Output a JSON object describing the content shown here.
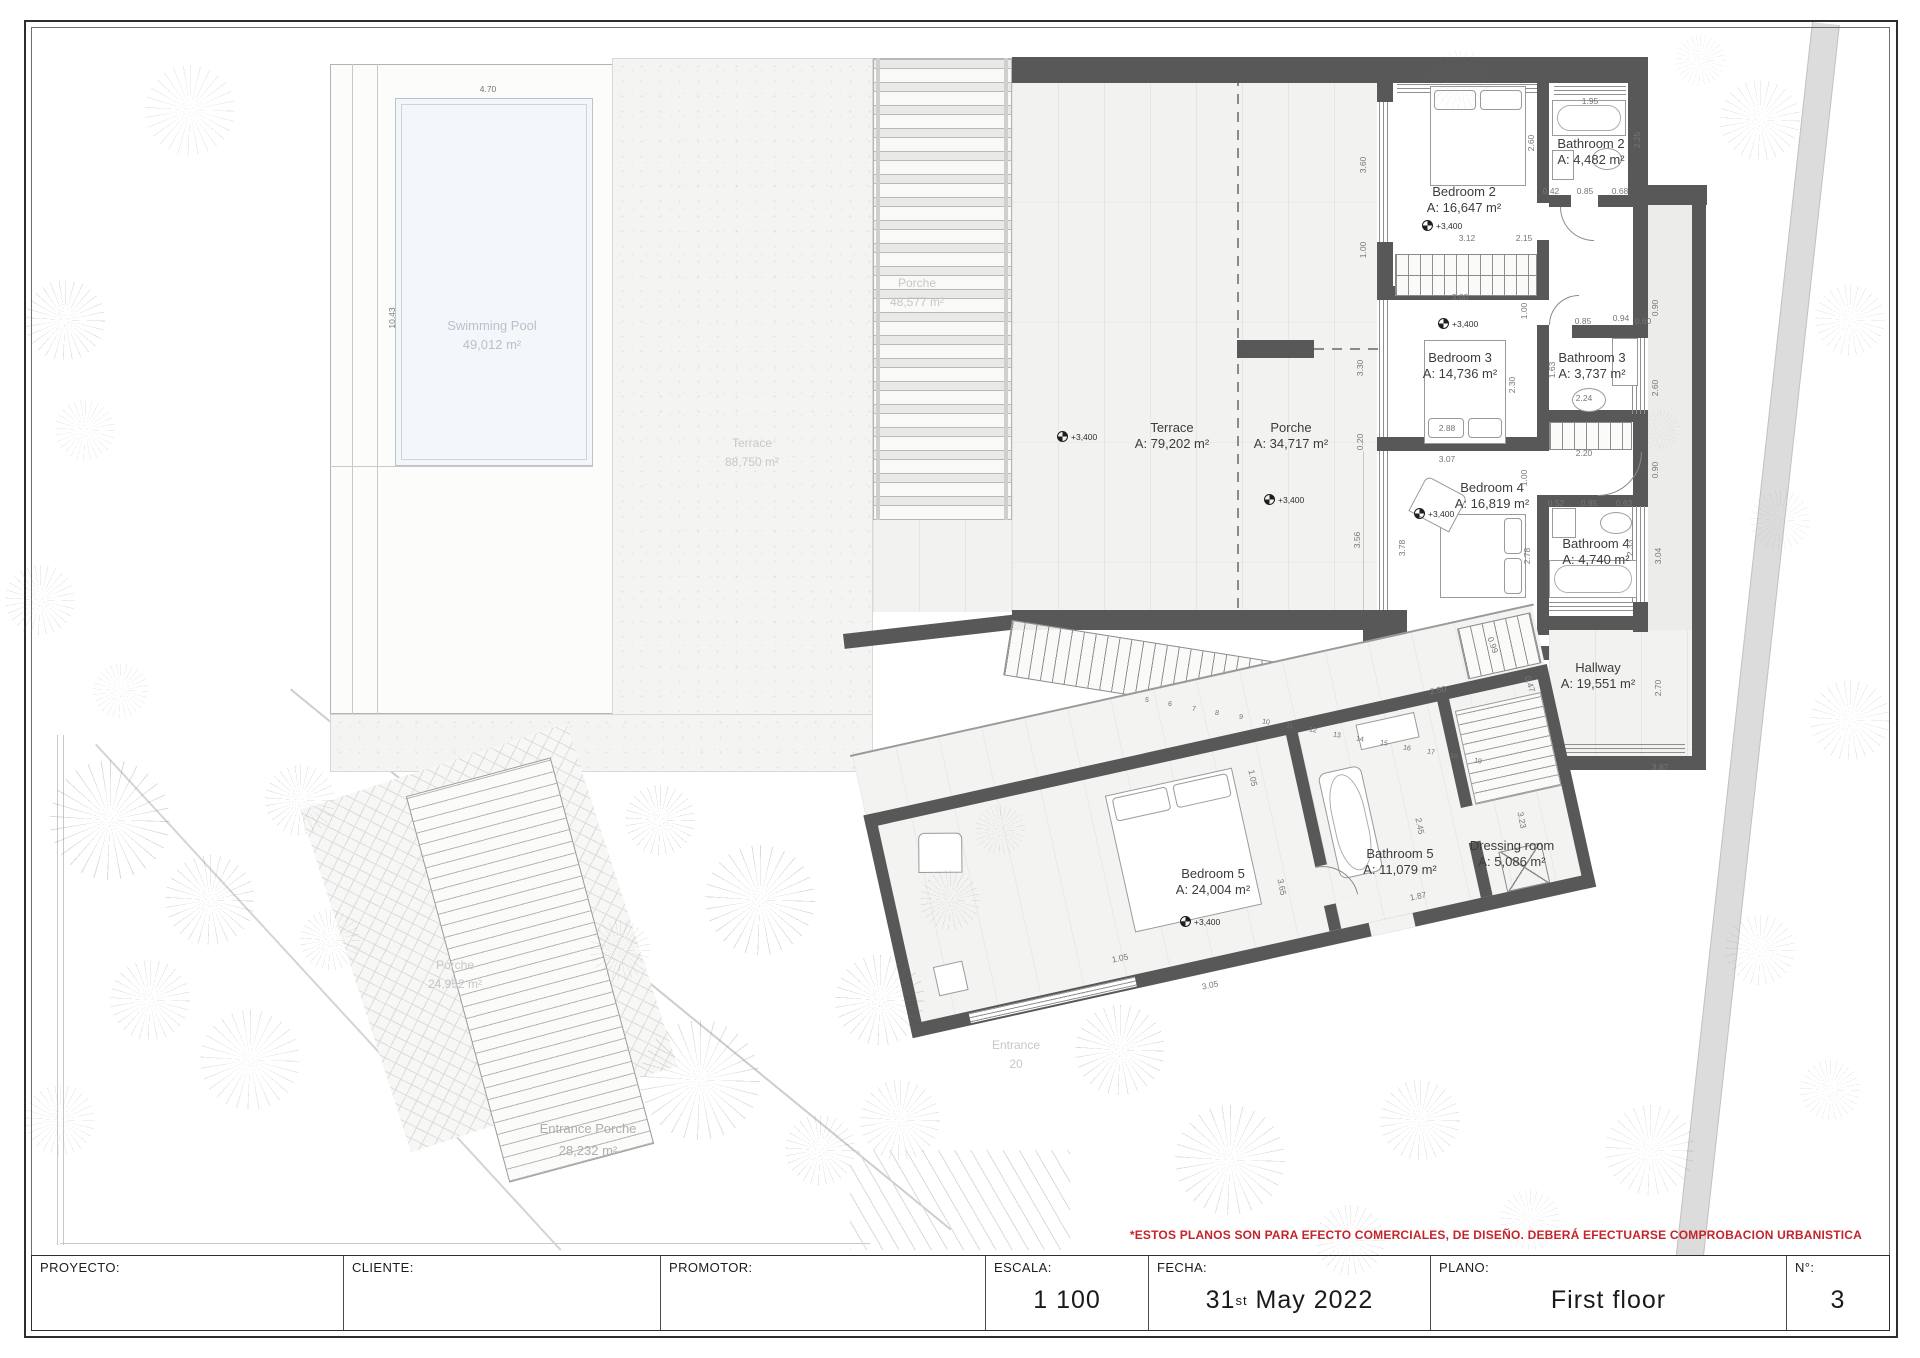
{
  "sheet": {
    "disclaimer": "*ESTOS PLANOS SON PARA EFECTO COMERCIALES, DE DISEÑO. DEBERÁ EFECTUARSE COMPROBACION URBANISTICA",
    "title_block": {
      "proyecto_label": "PROYECTO:",
      "cliente_label": "CLIENTE:",
      "promotor_label": "PROMOTOR:",
      "escala_label": "ESCALA:",
      "escala_value": "1 100",
      "fecha_label": "FECHA:",
      "fecha_day": "31",
      "fecha_sup": "st",
      "fecha_rest": "May 2022",
      "plano_label": "PLANO:",
      "plano_value": "First floor",
      "num_label": "N°:",
      "num_value": "3"
    }
  },
  "plan": {
    "room_labels": [
      {
        "name": "Terrace",
        "area": "A: 79,202 m²",
        "x": 1172,
        "y": 420
      },
      {
        "name": "Porche",
        "area": "A: 34,717 m²",
        "x": 1291,
        "y": 420
      },
      {
        "name": "Bedroom 2",
        "area": "A: 16,647 m²",
        "x": 1464,
        "y": 184
      },
      {
        "name": "Bathroom 2",
        "area": "A: 4,482 m²",
        "x": 1591,
        "y": 136
      },
      {
        "name": "Bedroom 3",
        "area": "A: 14,736 m²",
        "x": 1460,
        "y": 350
      },
      {
        "name": "Bathroom 3",
        "area": "A: 3,737 m²",
        "x": 1592,
        "y": 350
      },
      {
        "name": "Bedroom 4",
        "area": "A: 16,819 m²",
        "x": 1492,
        "y": 480
      },
      {
        "name": "Bathroom 4",
        "area": "A: 4,740 m²",
        "x": 1596,
        "y": 536
      },
      {
        "name": "Hallway",
        "area": "A: 19,551 m²",
        "x": 1598,
        "y": 660
      },
      {
        "name": "Bedroom 5",
        "area": "A: 24,004 m²",
        "x": 1213,
        "y": 866
      },
      {
        "name": "Bathroom 5",
        "area": "A: 11,079 m²",
        "x": 1400,
        "y": 846
      },
      {
        "name": "Dressing room",
        "area": "A: 5,086 m²",
        "x": 1512,
        "y": 838
      }
    ],
    "faint_labels": [
      {
        "name": "Swimming Pool",
        "area": "49,012 m²",
        "x": 492,
        "y": 316,
        "cls": "pool"
      },
      {
        "name": "Terrace",
        "area": "88,750 m²",
        "x": 752,
        "y": 434,
        "cls": ""
      },
      {
        "name": "Porche",
        "area": "48,577 m²",
        "x": 917,
        "y": 274,
        "cls": ""
      },
      {
        "name": "Porche",
        "area": "24,952 m²",
        "x": 455,
        "y": 956,
        "cls": ""
      },
      {
        "name": "Entrance Porche",
        "area": "28,232 m²",
        "x": 588,
        "y": 1118,
        "cls": "big"
      },
      {
        "name": "Entrance",
        "area": "20",
        "x": 1016,
        "y": 1036,
        "cls": ""
      }
    ],
    "level_markers": [
      {
        "t": "+3,400",
        "x": 1063,
        "y": 437
      },
      {
        "t": "+3,400",
        "x": 1270,
        "y": 500
      },
      {
        "t": "+3,400",
        "x": 1428,
        "y": 226
      },
      {
        "t": "+3,400",
        "x": 1444,
        "y": 324
      },
      {
        "t": "+3,400",
        "x": 1420,
        "y": 514
      },
      {
        "t": "+3,400",
        "x": 1186,
        "y": 922
      }
    ],
    "dims": [
      {
        "t": "4.70",
        "x": 488,
        "y": 89,
        "r": 0
      },
      {
        "t": "10.43",
        "x": 392,
        "y": 318,
        "r": -90
      },
      {
        "t": "3.60",
        "x": 1363,
        "y": 165,
        "r": -90
      },
      {
        "t": "1.00",
        "x": 1363,
        "y": 250,
        "r": -90
      },
      {
        "t": "3.12",
        "x": 1467,
        "y": 238,
        "r": 0
      },
      {
        "t": "2.15",
        "x": 1524,
        "y": 238,
        "r": 0
      },
      {
        "t": "1.95",
        "x": 1590,
        "y": 101,
        "r": 0
      },
      {
        "t": "2.25",
        "x": 1637,
        "y": 140,
        "r": -90
      },
      {
        "t": "2.60",
        "x": 1531,
        "y": 143,
        "r": -90
      },
      {
        "t": "0.42",
        "x": 1551,
        "y": 191,
        "r": 0
      },
      {
        "t": "0.85",
        "x": 1585,
        "y": 191,
        "r": 0
      },
      {
        "t": "0.68",
        "x": 1620,
        "y": 191,
        "r": 0
      },
      {
        "t": "3.00",
        "x": 1460,
        "y": 297,
        "r": 0
      },
      {
        "t": "1.00",
        "x": 1524,
        "y": 311,
        "r": -90
      },
      {
        "t": "0.94",
        "x": 1621,
        "y": 318,
        "r": 0
      },
      {
        "t": "0.85",
        "x": 1583,
        "y": 321,
        "r": 0
      },
      {
        "t": "0.60",
        "x": 1643,
        "y": 321,
        "r": 0
      },
      {
        "t": "2.30",
        "x": 1512,
        "y": 385,
        "r": -90
      },
      {
        "t": "1.63",
        "x": 1552,
        "y": 370,
        "r": -90
      },
      {
        "t": "2.24",
        "x": 1584,
        "y": 398,
        "r": 0
      },
      {
        "t": "2.88",
        "x": 1447,
        "y": 428,
        "r": 0
      },
      {
        "t": "3.07",
        "x": 1447,
        "y": 459,
        "r": 0
      },
      {
        "t": "0.90",
        "x": 1655,
        "y": 308,
        "r": -90
      },
      {
        "t": "2.60",
        "x": 1655,
        "y": 388,
        "r": -90
      },
      {
        "t": "0.90",
        "x": 1655,
        "y": 470,
        "r": -90
      },
      {
        "t": "2.20",
        "x": 1584,
        "y": 453,
        "r": 0
      },
      {
        "t": "0.52",
        "x": 1556,
        "y": 503,
        "r": 0
      },
      {
        "t": "0.85",
        "x": 1589,
        "y": 503,
        "r": 0
      },
      {
        "t": "0.63",
        "x": 1624,
        "y": 503,
        "r": 0
      },
      {
        "t": "2.33",
        "x": 1630,
        "y": 548,
        "r": -90
      },
      {
        "t": "3.04",
        "x": 1658,
        "y": 556,
        "r": -90
      },
      {
        "t": "2.70",
        "x": 1658,
        "y": 688,
        "r": -90
      },
      {
        "t": "3.56",
        "x": 1357,
        "y": 540,
        "r": -90
      },
      {
        "t": "3.78",
        "x": 1402,
        "y": 548,
        "r": -90
      },
      {
        "t": "2.78",
        "x": 1527,
        "y": 556,
        "r": -90
      },
      {
        "t": "1.00",
        "x": 1524,
        "y": 478,
        "r": -90
      },
      {
        "t": "3.87",
        "x": 1660,
        "y": 767,
        "r": 0
      },
      {
        "t": "0.99",
        "x": 1493,
        "y": 645,
        "r": 70
      },
      {
        "t": "0.47",
        "x": 1530,
        "y": 684,
        "r": 70
      },
      {
        "t": "3.30",
        "x": 1360,
        "y": 368,
        "r": -90
      },
      {
        "t": "0.20",
        "x": 1360,
        "y": 442,
        "r": -90
      },
      {
        "t": "2.50",
        "x": 1438,
        "y": 690,
        "r": -12
      },
      {
        "t": "1.05",
        "x": 1253,
        "y": 778,
        "r": 78
      },
      {
        "t": "3.65",
        "x": 1282,
        "y": 887,
        "r": 78
      },
      {
        "t": "1.87",
        "x": 1418,
        "y": 896,
        "r": -12
      },
      {
        "t": "1.05",
        "x": 1120,
        "y": 958,
        "r": -12
      },
      {
        "t": "3.23",
        "x": 1522,
        "y": 820,
        "r": 78
      },
      {
        "t": "2.45",
        "x": 1420,
        "y": 826,
        "r": 78
      },
      {
        "t": "3.05",
        "x": 1210,
        "y": 985,
        "r": -12
      }
    ],
    "stair_numbers": [
      {
        "n": "5",
        "x": 1145,
        "y": 697
      },
      {
        "n": "6",
        "x": 1168,
        "y": 701
      },
      {
        "n": "7",
        "x": 1192,
        "y": 706
      },
      {
        "n": "8",
        "x": 1215,
        "y": 710
      },
      {
        "n": "9",
        "x": 1239,
        "y": 714
      },
      {
        "n": "10",
        "x": 1262,
        "y": 719
      },
      {
        "n": "11",
        "x": 1286,
        "y": 723
      },
      {
        "n": "12",
        "x": 1309,
        "y": 727
      },
      {
        "n": "13",
        "x": 1333,
        "y": 732
      },
      {
        "n": "14",
        "x": 1356,
        "y": 736
      },
      {
        "n": "15",
        "x": 1380,
        "y": 740
      },
      {
        "n": "16",
        "x": 1403,
        "y": 745
      },
      {
        "n": "17",
        "x": 1427,
        "y": 749
      },
      {
        "n": "18",
        "x": 1450,
        "y": 753
      },
      {
        "n": "19",
        "x": 1474,
        "y": 758
      }
    ]
  }
}
